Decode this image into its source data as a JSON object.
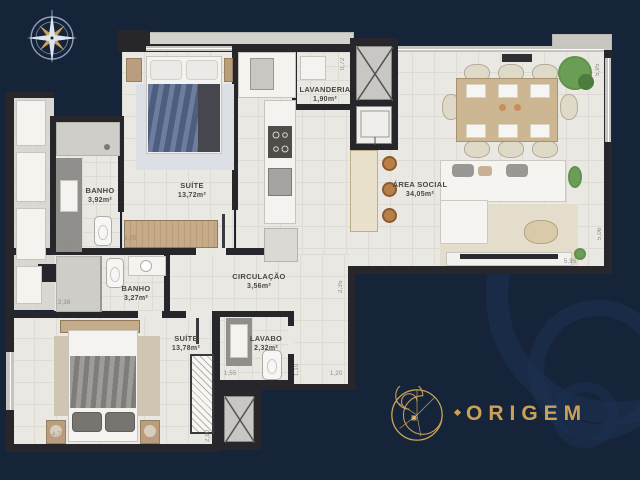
{
  "brand": {
    "background_color": "#16243A",
    "accent_gold": "#C9A257",
    "wall_color": "#26262B",
    "floor_color": "#EAE8E3"
  },
  "compass": {
    "icon": "compass-rose-icon"
  },
  "rooms": [
    {
      "name": "SUÍTE",
      "area": "13,72m²"
    },
    {
      "name": "BANHO",
      "area": "3,92m²"
    },
    {
      "name": "LAVANDERIA",
      "area": "1,90m²"
    },
    {
      "name": "ÁREA SOCIAL",
      "area": "34,05m²"
    },
    {
      "name": "CIRCULAÇÃO",
      "area": "3,56m²"
    },
    {
      "name": "BANHO",
      "area": "3,27m²"
    },
    {
      "name": "SUÍTE",
      "area": "13,78m²"
    },
    {
      "name": "LAVABO",
      "area": "2,32m²"
    }
  ],
  "dimensions": [
    {
      "value": "0,72"
    },
    {
      "value": "5,95"
    },
    {
      "value": "1,40"
    },
    {
      "value": "3,05"
    },
    {
      "value": "2,38"
    },
    {
      "value": "5,06"
    },
    {
      "value": "5,95"
    },
    {
      "value": "2,35"
    },
    {
      "value": "1,10"
    },
    {
      "value": "1,55"
    },
    {
      "value": "1,20"
    },
    {
      "value": "2,90"
    },
    {
      "value": "4,75"
    }
  ],
  "logo": {
    "text": "ORIGEM"
  }
}
